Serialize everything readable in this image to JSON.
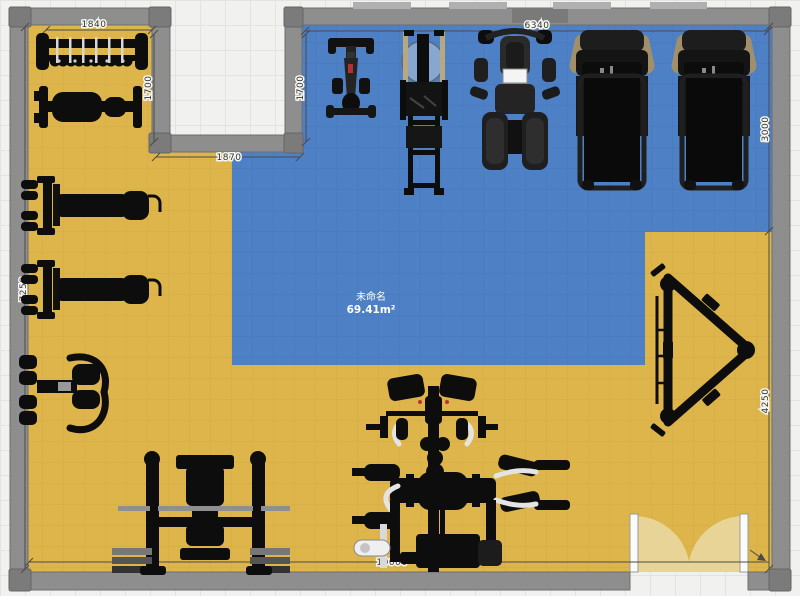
{
  "app": {
    "name": "floor-planner-canvas",
    "view": "2d-top-view-gym-layout"
  },
  "zone": {
    "name": "未命名",
    "area": "69.41m²"
  },
  "dimensions": {
    "top_left_width": "1840",
    "left_section_height": "1700",
    "notch_width": "1870",
    "zone_top_width": "6340",
    "zone_left_height": "1700",
    "right_upper_height": "3000",
    "right_lower_height": "4250",
    "left_total_height": "7250",
    "bottom_width": "10000"
  },
  "equipment": [
    {
      "id": "dumbbell-rack",
      "label": "dumbbell rack"
    },
    {
      "id": "flat-bench",
      "label": "adjustable flat bench"
    },
    {
      "id": "press-machine-upper",
      "label": "plate loaded press machine"
    },
    {
      "id": "press-machine-lower",
      "label": "plate loaded press machine"
    },
    {
      "id": "preacher-curl-bench",
      "label": "preacher curl bench"
    },
    {
      "id": "bench-press-station",
      "label": "bench press rack with barbell and plates"
    },
    {
      "id": "multi-gym-station",
      "label": "multi-gym cable station"
    },
    {
      "id": "leg-press-sled",
      "label": "leg press sled frame"
    },
    {
      "id": "exercise-bike",
      "label": "exercise bike"
    },
    {
      "id": "climber-machine",
      "label": "fan rower / climber machine"
    },
    {
      "id": "multi-press-station",
      "label": "seated multi press station"
    },
    {
      "id": "treadmill-1",
      "label": "treadmill"
    },
    {
      "id": "treadmill-2",
      "label": "treadmill"
    }
  ],
  "colors": {
    "floor": "#deb54b",
    "zone": "#4d80c5",
    "wall": "#8e8e8e",
    "door_arc": "#e9d498",
    "background": "#f1f1ef"
  }
}
